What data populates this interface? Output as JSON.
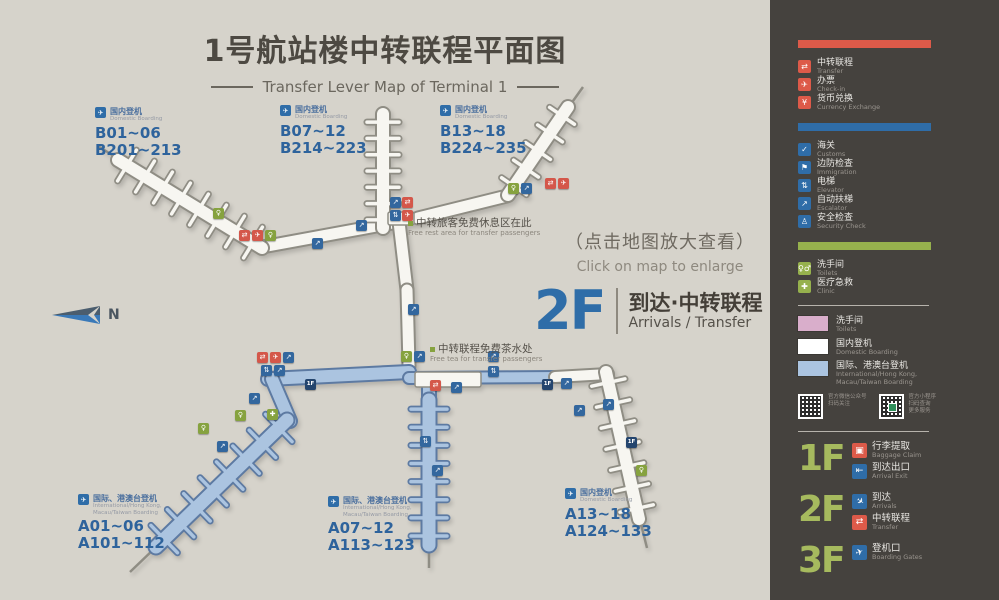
{
  "colors": {
    "map_bg": "#d6d3cb",
    "sidebar": "#45423e",
    "red": "#dd5a49",
    "blue": "#2f6da8",
    "navy": "#24456e",
    "green": "#96b14d",
    "green_text": "#a6ba5e",
    "pink": "#d9aecb",
    "intl_blue": "#abc4e0",
    "white_pier": "#f7f6f1",
    "gate_text": "#2e639c",
    "title": "#4d4942"
  },
  "title": {
    "zh": "1号航站楼中转联程平面图",
    "en": "Transfer Lever Map of Terminal 1"
  },
  "map": {
    "click_hint_zh": "（点击地图放大查看）",
    "click_hint_en": "Click on map to enlarge",
    "floor_badge": {
      "floor": "2F",
      "zh": "到达·中转联程",
      "en": "Arrivals / Transfer"
    },
    "compass_label": "N",
    "gate_groups": [
      {
        "id": "b01",
        "x": 95,
        "y": 107,
        "tag_zh": "国内登机",
        "tag_en": "Domestic Boarding",
        "lines": [
          "B01~06",
          "B201~213"
        ]
      },
      {
        "id": "b07",
        "x": 280,
        "y": 105,
        "tag_zh": "国内登机",
        "tag_en": "Domestic Boarding",
        "lines": [
          "B07~12",
          "B214~223"
        ]
      },
      {
        "id": "b13",
        "x": 440,
        "y": 105,
        "tag_zh": "国内登机",
        "tag_en": "Domestic Boarding",
        "lines": [
          "B13~18",
          "B224~235"
        ]
      },
      {
        "id": "a01",
        "x": 78,
        "y": 494,
        "tag_zh": "国际、港澳台登机",
        "tag_en": "International/Hong Kong, Macau/Taiwan Boarding",
        "lines": [
          "A01~06",
          "A101~112"
        ]
      },
      {
        "id": "a07",
        "x": 328,
        "y": 496,
        "tag_zh": "国际、港澳台登机",
        "tag_en": "International/Hong Kong, Macau/Taiwan Boarding",
        "lines": [
          "A07~12",
          "A113~123"
        ]
      },
      {
        "id": "a13",
        "x": 565,
        "y": 488,
        "tag_zh": "国内登机",
        "tag_en": "Domestic Boarding",
        "lines": [
          "A13~18",
          "A124~133"
        ]
      }
    ],
    "annotations": [
      {
        "x": 408,
        "y": 218,
        "zh": "中转旅客免费休息区在此",
        "en": "Free rest area for transfer passengers"
      },
      {
        "x": 430,
        "y": 344,
        "zh": "中转联程免费茶水处",
        "en": "Free tea for transfer passengers"
      }
    ],
    "markers": [
      {
        "t": "toilet",
        "x": 213,
        "y": 208
      },
      {
        "t": "transfer",
        "x": 239,
        "y": 230
      },
      {
        "t": "checkin",
        "x": 252,
        "y": 230
      },
      {
        "t": "toilet",
        "x": 265,
        "y": 230
      },
      {
        "t": "escalator",
        "x": 312,
        "y": 238
      },
      {
        "t": "escalator",
        "x": 356,
        "y": 220
      },
      {
        "t": "escalator",
        "x": 390,
        "y": 197
      },
      {
        "t": "transfer",
        "x": 402,
        "y": 197
      },
      {
        "t": "elevator",
        "x": 390,
        "y": 210
      },
      {
        "t": "checkin",
        "x": 402,
        "y": 210
      },
      {
        "t": "toilet",
        "x": 508,
        "y": 183
      },
      {
        "t": "escalator",
        "x": 521,
        "y": 183
      },
      {
        "t": "transfer",
        "x": 545,
        "y": 178
      },
      {
        "t": "checkin",
        "x": 558,
        "y": 178
      },
      {
        "t": "escalator",
        "x": 408,
        "y": 304
      },
      {
        "t": "toilet",
        "x": 401,
        "y": 351
      },
      {
        "t": "escalator",
        "x": 414,
        "y": 351
      },
      {
        "t": "transfer",
        "x": 257,
        "y": 352
      },
      {
        "t": "checkin",
        "x": 270,
        "y": 352
      },
      {
        "t": "escalator",
        "x": 283,
        "y": 352
      },
      {
        "t": "elevator",
        "x": 261,
        "y": 365
      },
      {
        "t": "escalator",
        "x": 274,
        "y": 365
      },
      {
        "t": "floor1",
        "x": 305,
        "y": 379
      },
      {
        "t": "escalator",
        "x": 249,
        "y": 393
      },
      {
        "t": "toilet",
        "x": 235,
        "y": 410
      },
      {
        "t": "clinic",
        "x": 267,
        "y": 409
      },
      {
        "t": "toilet",
        "x": 198,
        "y": 423
      },
      {
        "t": "escalator",
        "x": 217,
        "y": 441
      },
      {
        "t": "transfer",
        "x": 430,
        "y": 380
      },
      {
        "t": "escalator",
        "x": 451,
        "y": 382
      },
      {
        "t": "escalator",
        "x": 488,
        "y": 351
      },
      {
        "t": "elevator",
        "x": 488,
        "y": 366
      },
      {
        "t": "floor1",
        "x": 542,
        "y": 379
      },
      {
        "t": "escalator",
        "x": 561,
        "y": 378
      },
      {
        "t": "escalator",
        "x": 603,
        "y": 399
      },
      {
        "t": "floor1",
        "x": 626,
        "y": 437
      },
      {
        "t": "toilet",
        "x": 636,
        "y": 465
      },
      {
        "t": "escalator",
        "x": 432,
        "y": 465
      },
      {
        "t": "elevator",
        "x": 420,
        "y": 436
      },
      {
        "t": "escalator",
        "x": 574,
        "y": 405
      }
    ]
  },
  "legend": {
    "groups": [
      {
        "accent": "#dd5a49",
        "name": "red-group",
        "items": [
          {
            "icon": "transfer-icon",
            "zh": "中转联程",
            "en": "Transfer"
          },
          {
            "icon": "checkin-icon",
            "zh": "办票",
            "en": "Check-in"
          },
          {
            "icon": "currency-exchange-icon",
            "zh": "货币兑换",
            "en": "Currency Exchange"
          }
        ]
      },
      {
        "accent": "#2f6da8",
        "name": "blue-group",
        "items": [
          {
            "icon": "customs-icon",
            "zh": "海关",
            "en": "Customs"
          },
          {
            "icon": "immigration-icon",
            "zh": "边防检查",
            "en": "Immigration"
          },
          {
            "icon": "elevator-icon",
            "zh": "电梯",
            "en": "Elevator"
          },
          {
            "icon": "escalator-icon",
            "zh": "自动扶梯",
            "en": "Escalator"
          },
          {
            "icon": "security-check-icon",
            "zh": "安全检查",
            "en": "Security Check"
          }
        ]
      },
      {
        "accent": "#96b14d",
        "name": "green-group",
        "items": [
          {
            "icon": "toilet-icon",
            "zh": "洗手间",
            "en": "Toilets"
          },
          {
            "icon": "clinic-icon",
            "zh": "医疗急救",
            "en": "Clinic"
          }
        ]
      }
    ],
    "swatches": [
      {
        "color": "#d9aecb",
        "zh": "洗手间",
        "en": "Toilets"
      },
      {
        "color": "#ffffff",
        "zh": "国内登机",
        "en": "Domestic Boarding"
      },
      {
        "color": "#abc4e0",
        "zh": "国际、港澳台登机",
        "en": "International/Hong Kong, Macau/Taiwan Boarding"
      }
    ],
    "qr": [
      {
        "caption_lines": [
          "官方微信公众号",
          "扫码关注"
        ]
      },
      {
        "caption_lines": [
          "官方小程序",
          "扫码查询",
          "更多服务"
        ]
      }
    ],
    "floors": [
      {
        "label": "1F",
        "entries": [
          {
            "icon": "baggage-claim-icon",
            "color": "#dd5a49",
            "zh": "行李提取",
            "en": "Baggage Claim"
          },
          {
            "icon": "arrival-exit-icon",
            "color": "#2f6da8",
            "zh": "到达出口",
            "en": "Arrival Exit"
          }
        ]
      },
      {
        "label": "2F",
        "entries": [
          {
            "icon": "arrivals-icon",
            "color": "#2f6da8",
            "zh": "到达",
            "en": "Arrivals"
          },
          {
            "icon": "transfer-icon",
            "color": "#dd5a49",
            "zh": "中转联程",
            "en": "Transfer"
          }
        ]
      },
      {
        "label": "3F",
        "entries": [
          {
            "icon": "boarding-gates-icon",
            "color": "#2f6da8",
            "zh": "登机口",
            "en": "Boarding Gates"
          }
        ]
      }
    ]
  }
}
